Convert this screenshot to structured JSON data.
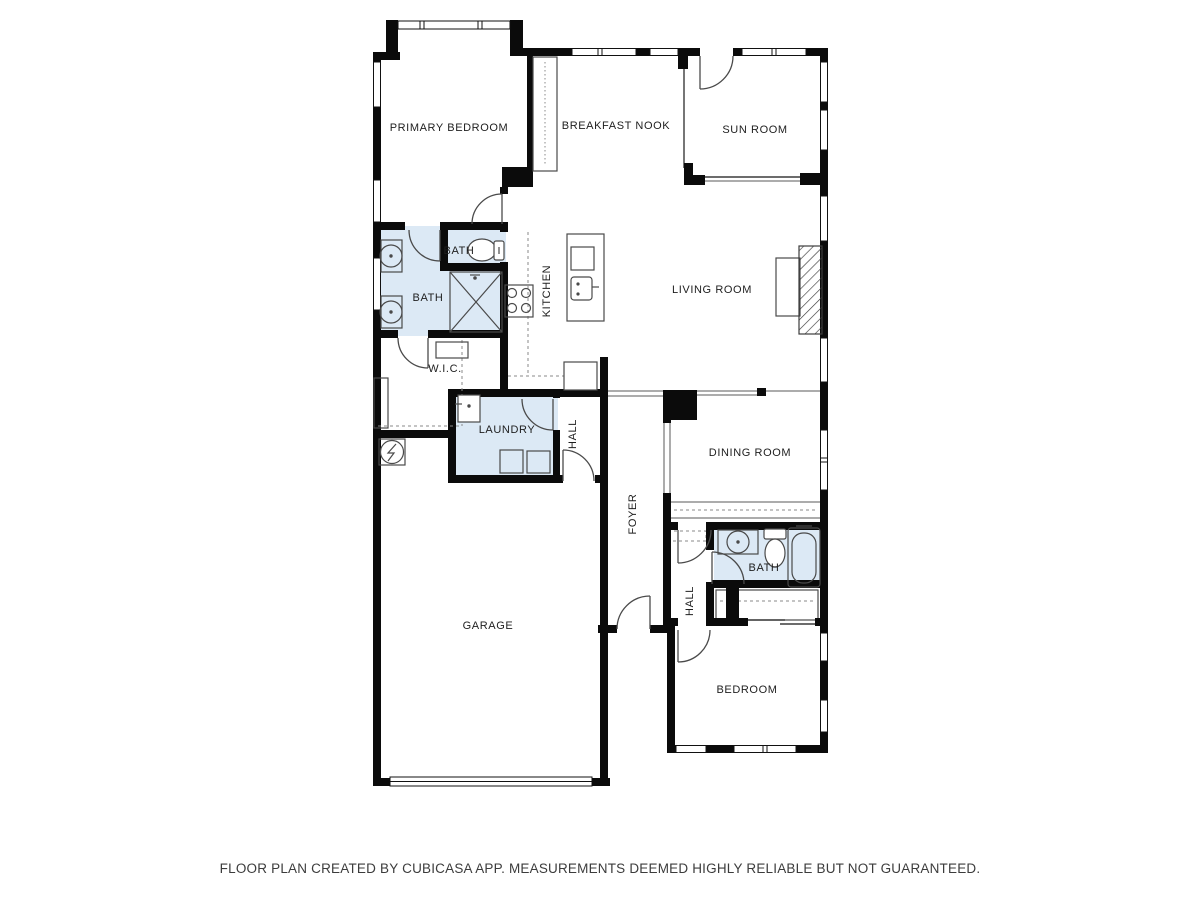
{
  "rooms": [
    {
      "id": "primary-bedroom",
      "label": "PRIMARY BEDROOM"
    },
    {
      "id": "breakfast-nook",
      "label": "BREAKFAST NOOK"
    },
    {
      "id": "sun-room",
      "label": "SUN ROOM"
    },
    {
      "id": "bath-upper-small",
      "label": "BATH"
    },
    {
      "id": "bath-primary",
      "label": "BATH"
    },
    {
      "id": "kitchen",
      "label": "KITCHEN"
    },
    {
      "id": "living-room",
      "label": "LIVING ROOM"
    },
    {
      "id": "walk-in-closet",
      "label": "W.I.C."
    },
    {
      "id": "laundry",
      "label": "LAUNDRY"
    },
    {
      "id": "hall-upper",
      "label": "HALL"
    },
    {
      "id": "dining-room",
      "label": "DINING ROOM"
    },
    {
      "id": "foyer",
      "label": "FOYER"
    },
    {
      "id": "bath-lower",
      "label": "BATH"
    },
    {
      "id": "hall-lower",
      "label": "HALL"
    },
    {
      "id": "garage",
      "label": "GARAGE"
    },
    {
      "id": "bedroom",
      "label": "BEDROOM"
    }
  ],
  "footer": {
    "disclaimer": "FLOOR PLAN CREATED BY CUBICASA APP. MEASUREMENTS DEEMED HIGHLY RELIABLE BUT NOT GUARANTEED."
  },
  "colors": {
    "wall": "#0b0b0b",
    "wet_room_fill": "#dce9f5",
    "thin_line": "#3c3c3c",
    "label_text": "#1e1e1e",
    "footer_text": "#3c3c3c"
  },
  "fixtures": [
    "bathtub",
    "toilet",
    "sink",
    "double-sink",
    "shower",
    "washer",
    "dryer",
    "stove",
    "kitchen-island",
    "fireplace",
    "water-heater",
    "garage-door",
    "window",
    "interior-door",
    "closet-rail"
  ]
}
